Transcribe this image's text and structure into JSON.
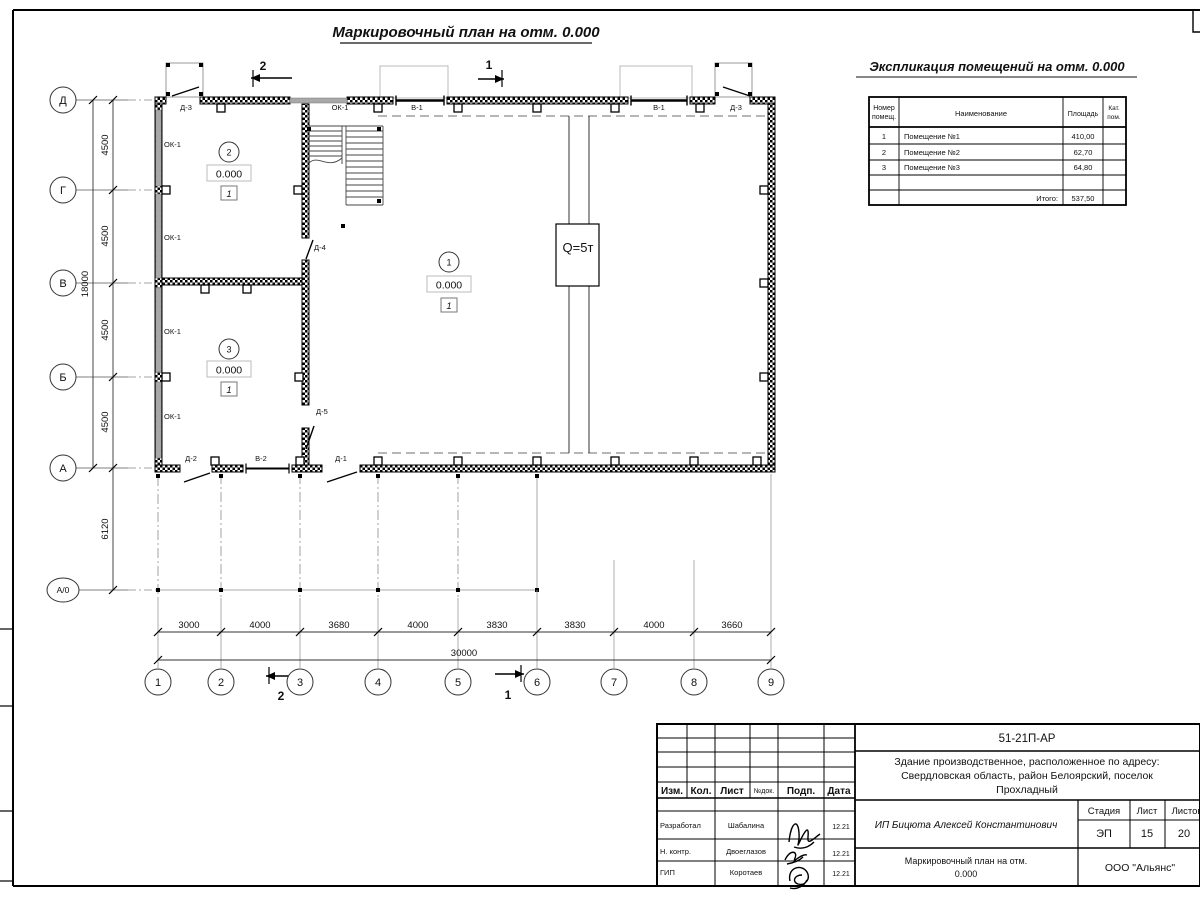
{
  "sheet": {
    "plan_title": "Маркировочный план на отм. 0.000",
    "schedule_title": "Экспликация помещений на отм. 0.000"
  },
  "plan": {
    "row_axes": [
      "Д",
      "Г",
      "В",
      "Б",
      "А",
      "А/0"
    ],
    "col_axes": [
      "1",
      "2",
      "3",
      "4",
      "5",
      "6",
      "7",
      "8",
      "9"
    ],
    "left_dims": [
      "4500",
      "4500",
      "4500",
      "4500"
    ],
    "left_total": "18000",
    "canopy_dim": "6120",
    "bottom_dims": [
      "3000",
      "4000",
      "3680",
      "4000",
      "3830",
      "3830",
      "4000",
      "3660"
    ],
    "bottom_total": "30000",
    "top_wall_labels": [
      "Д-3",
      "ОК-1",
      "В-1",
      "В-1",
      "Д-3"
    ],
    "left_wall_labels": [
      "ОК-1",
      "ОК-1",
      "ОК-1",
      "ОК-1"
    ],
    "bottom_wall_labels": [
      "Д-2",
      "В-2",
      "Д-1"
    ],
    "inner_door_labels": [
      "Д-4",
      "Д-5"
    ],
    "crane_label": "Q=5т",
    "sections": {
      "top_left": "2",
      "top_right": "1",
      "bottom_left": "2",
      "bottom_right": "1"
    },
    "rooms": [
      {
        "num": "1",
        "elev": "0.000",
        "floor_type": "1"
      },
      {
        "num": "2",
        "elev": "0.000",
        "floor_type": "1"
      },
      {
        "num": "3",
        "elev": "0.000",
        "floor_type": "1"
      }
    ]
  },
  "schedule": {
    "col_num_l1": "Номер",
    "col_num_l2": "помещ.",
    "col_name": "Наименование",
    "col_area": "Площадь",
    "col_cat_l1": "Кат.",
    "col_cat_l2": "пом.",
    "rows": [
      {
        "num": "1",
        "name": "Помещение №1",
        "area": "410,00"
      },
      {
        "num": "2",
        "name": "Помещение №2",
        "area": "62,70"
      },
      {
        "num": "3",
        "name": "Помещение №3",
        "area": "64,80"
      }
    ],
    "total_label": "Итого:",
    "total_value": "537,50"
  },
  "titleblock": {
    "doc_number": "51-21П-АР",
    "address_l1": "Здание производственное, расположенное по адресу:",
    "address_l2": "Свердловская область, район Белоярский, поселок",
    "address_l3": "Прохладный",
    "col_izm": "Изм.",
    "col_kol": "Кол.",
    "col_list": "Лист",
    "col_ndok": "№док.",
    "col_podp": "Подп.",
    "col_data": "Дата",
    "sign_rows": [
      {
        "role": "Разработал",
        "name": "Шабалина",
        "date": "12.21"
      },
      {
        "role": "Н. контр.",
        "name": "Двоеглазов",
        "date": "12.21"
      },
      {
        "role": "ГИП",
        "name": "Коротаев",
        "date": "12.21"
      }
    ],
    "customer": "ИП Бицюта Алексей Константинович",
    "stage_label": "Стадия",
    "sheet_label": "Лист",
    "sheets_label": "Листов",
    "stage": "ЭП",
    "sheet_num": "15",
    "sheets_total": "20",
    "drawing_l1": "Маркировочный план на отм.",
    "drawing_l2": "0.000",
    "org": "ООО \"Альянс\""
  }
}
